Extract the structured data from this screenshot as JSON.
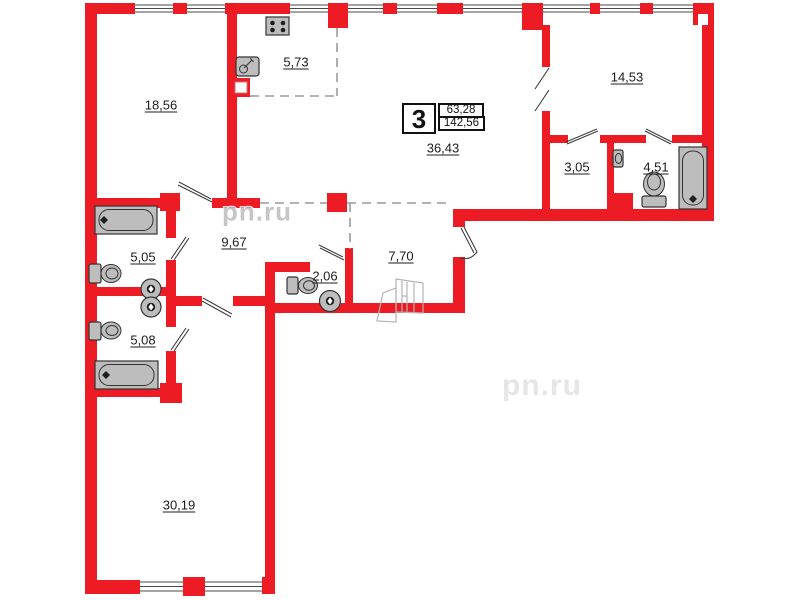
{
  "plan": {
    "badge": {
      "room_count": "3",
      "area_living": "63,28",
      "area_total": "142,56"
    },
    "rooms": [
      {
        "name": "bedroom-top-left",
        "area": "18,56"
      },
      {
        "name": "kitchen-zone",
        "area": "5,73"
      },
      {
        "name": "bedroom-top-right",
        "area": "14,53"
      },
      {
        "name": "living-kitchen-zone",
        "area": "36,43"
      },
      {
        "name": "storage-room",
        "area": "3,05"
      },
      {
        "name": "bathroom-right",
        "area": "4,51"
      },
      {
        "name": "corridor",
        "area": "9,67"
      },
      {
        "name": "bathroom-left-upper",
        "area": "5,05"
      },
      {
        "name": "wc-small",
        "area": "2,06"
      },
      {
        "name": "entrance-hall",
        "area": "7,70"
      },
      {
        "name": "bathroom-left-lower",
        "area": "5,08"
      },
      {
        "name": "living-room-bottom",
        "area": "30,19"
      }
    ],
    "watermarks": [
      "pn.ru",
      "pn.ru"
    ],
    "colors": {
      "wall": "#ed1c24",
      "fixture": "#bdbdbd",
      "dashed": "#9a9a9a",
      "text": "#1c1c1c"
    }
  }
}
